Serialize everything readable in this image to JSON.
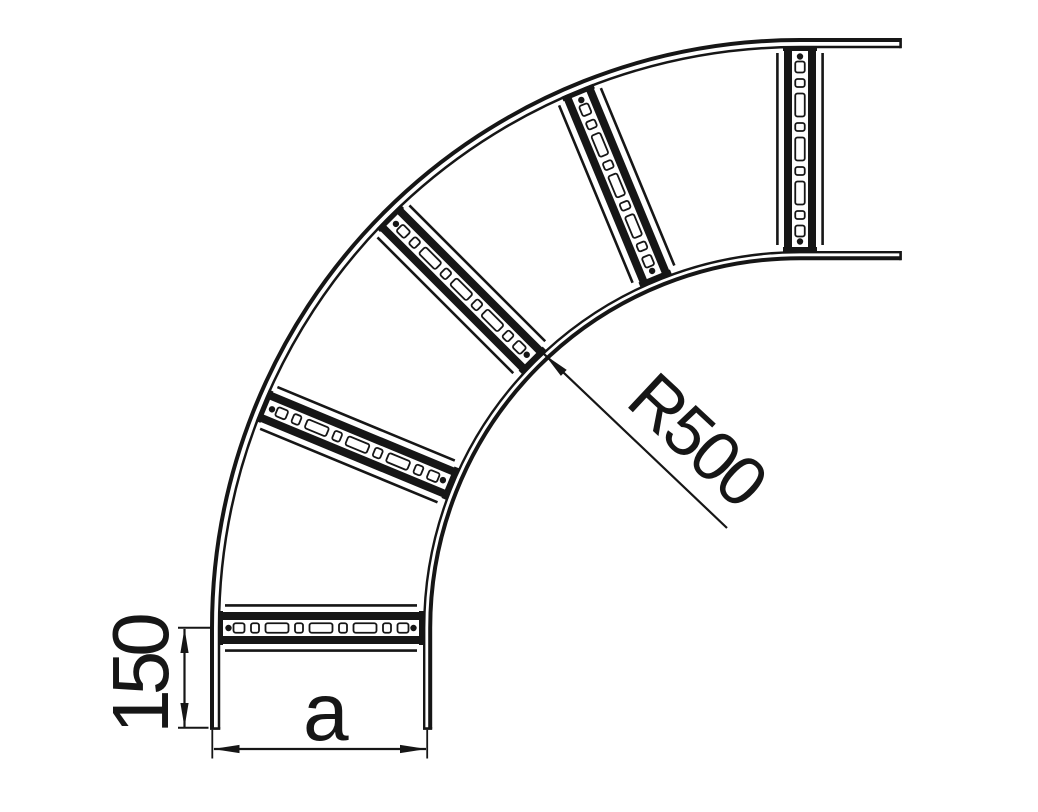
{
  "drawing": {
    "background_color": "#ffffff",
    "line_color": "#161616",
    "labels": {
      "radius": "R500",
      "tangent_length": "150",
      "width": "a"
    }
  },
  "geometry": {
    "canvas": {
      "width": 1038,
      "height": 812
    },
    "bend_angle_deg": 90,
    "center": {
      "x": 800,
      "y": 628
    },
    "outer_rail_radii": [
      588,
      581
    ],
    "inner_rail_radii": [
      375.8,
      369.8
    ],
    "rail_end_bottom_y": 728.6,
    "rail_end_right_x": 900.6,
    "rung_outer_radius": 582,
    "rung_length": 206,
    "rung_angles_deg": [
      0,
      22.5,
      45,
      67.5,
      90
    ],
    "rung_slot_widths": [
      11,
      8,
      23,
      8,
      23,
      8,
      23,
      8,
      11
    ],
    "rung_slot_gap": 6.5
  }
}
